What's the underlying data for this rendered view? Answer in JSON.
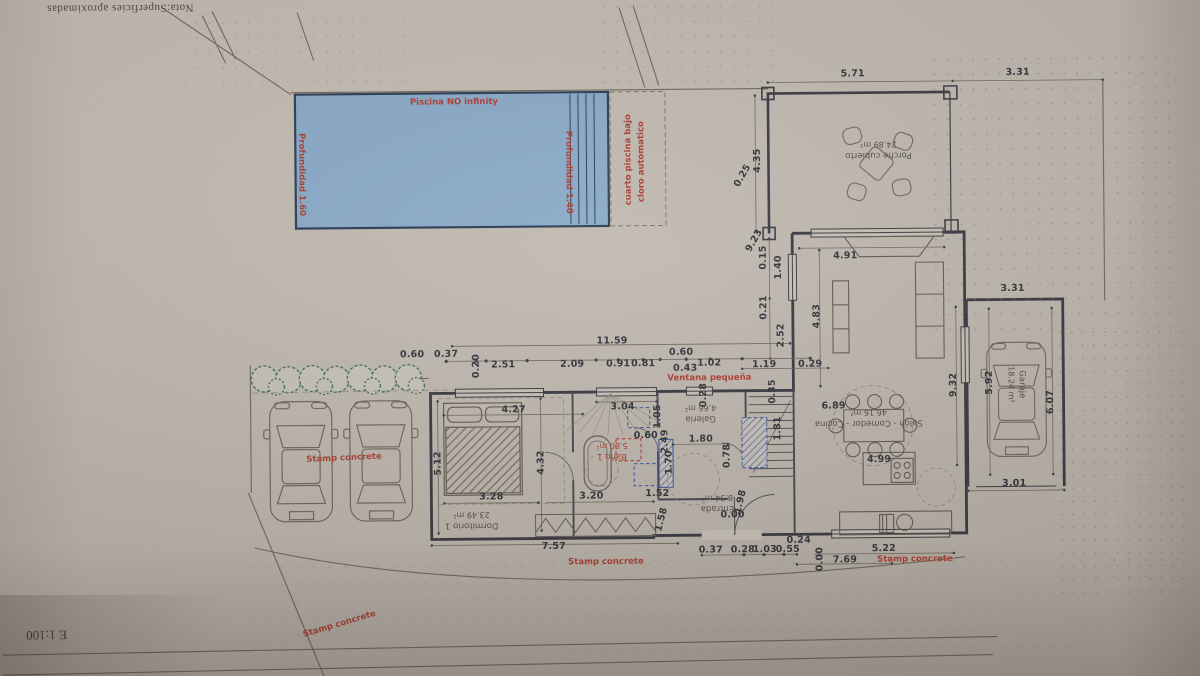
{
  "sheet": {
    "note_top": "Nota:Superficies aproximadas",
    "scale_label": "E 1:100"
  },
  "annotations": {
    "dims": [
      {
        "t": "5.71",
        "x": 855,
        "y": 76
      },
      {
        "t": "3.31",
        "x": 1020,
        "y": 76
      },
      {
        "t": "4.35",
        "x": 759,
        "y": 162,
        "r": -90
      },
      {
        "t": "0.25",
        "x": 744,
        "y": 177,
        "r": -60
      },
      {
        "t": "9.23",
        "x": 755,
        "y": 242,
        "r": -60
      },
      {
        "t": "0.15",
        "x": 764,
        "y": 259,
        "r": -90
      },
      {
        "t": "1.40",
        "x": 779,
        "y": 269,
        "r": -90
      },
      {
        "t": "0.21",
        "x": 764,
        "y": 309,
        "r": -90
      },
      {
        "t": "2.52",
        "x": 781,
        "y": 337,
        "r": -90
      },
      {
        "t": "4.83",
        "x": 817,
        "y": 318,
        "r": -90
      },
      {
        "t": "1.19",
        "x": 764,
        "y": 366
      },
      {
        "t": "0.29",
        "x": 810,
        "y": 366
      },
      {
        "t": "4.91",
        "x": 846,
        "y": 258
      },
      {
        "t": "6.89",
        "x": 833,
        "y": 408
      },
      {
        "t": "4.99",
        "x": 878,
        "y": 462
      },
      {
        "t": "9.32",
        "x": 953,
        "y": 388,
        "r": -90
      },
      {
        "t": "3.31",
        "x": 1013,
        "y": 292
      },
      {
        "t": "5.92",
        "x": 989,
        "y": 386,
        "r": -90
      },
      {
        "t": "6.07",
        "x": 1050,
        "y": 406,
        "r": -90
      },
      {
        "t": "3.01",
        "x": 1013,
        "y": 487
      },
      {
        "t": "11.59",
        "x": 612,
        "y": 341
      },
      {
        "t": "0.60",
        "x": 412,
        "y": 353
      },
      {
        "t": "0.37",
        "x": 446,
        "y": 353
      },
      {
        "t": "0.20",
        "x": 476,
        "y": 365,
        "r": -90
      },
      {
        "t": "2.51",
        "x": 503,
        "y": 364
      },
      {
        "t": "2.09",
        "x": 572,
        "y": 364
      },
      {
        "t": "0.91",
        "x": 618,
        "y": 364
      },
      {
        "t": "0.81",
        "x": 643,
        "y": 364
      },
      {
        "t": "0.60",
        "x": 681,
        "y": 353
      },
      {
        "t": "0.43",
        "x": 685,
        "y": 369
      },
      {
        "t": "1.02",
        "x": 709,
        "y": 364
      },
      {
        "t": "4.27",
        "x": 513,
        "y": 409
      },
      {
        "t": "3.04",
        "x": 622,
        "y": 407
      },
      {
        "t": "1.05",
        "x": 657,
        "y": 417,
        "r": -90
      },
      {
        "t": "2.49",
        "x": 664,
        "y": 442,
        "r": -90
      },
      {
        "t": "0.60",
        "x": 645,
        "y": 436
      },
      {
        "t": "1.70",
        "x": 668,
        "y": 463,
        "r": -90
      },
      {
        "t": "1.80",
        "x": 700,
        "y": 440
      },
      {
        "t": "0.28",
        "x": 703,
        "y": 396,
        "r": -90
      },
      {
        "t": "0.35",
        "x": 772,
        "y": 393,
        "r": -90
      },
      {
        "t": "1.81",
        "x": 777,
        "y": 430,
        "r": -90
      },
      {
        "t": "5.12",
        "x": 437,
        "y": 462,
        "r": -90
      },
      {
        "t": "4.32",
        "x": 540,
        "y": 462,
        "r": -90
      },
      {
        "t": "3.28",
        "x": 490,
        "y": 496
      },
      {
        "t": "3.20",
        "x": 590,
        "y": 496
      },
      {
        "t": "1.52",
        "x": 656,
        "y": 494
      },
      {
        "t": "1.58",
        "x": 660,
        "y": 520,
        "r": -75
      },
      {
        "t": "0.78",
        "x": 726,
        "y": 457,
        "r": -90
      },
      {
        "t": "1.98",
        "x": 739,
        "y": 503,
        "r": -75
      },
      {
        "t": "0.00",
        "x": 731,
        "y": 516
      },
      {
        "t": "7.57",
        "x": 552,
        "y": 546
      },
      {
        "t": "0.37",
        "x": 709,
        "y": 551
      },
      {
        "t": "0.28",
        "x": 741,
        "y": 551
      },
      {
        "t": "1.03",
        "x": 763,
        "y": 551
      },
      {
        "t": "0.55",
        "x": 786,
        "y": 551
      },
      {
        "t": "0.24",
        "x": 797,
        "y": 542
      },
      {
        "t": "0.00",
        "x": 818,
        "y": 561,
        "r": -90
      },
      {
        "t": "7.69",
        "x": 843,
        "y": 562
      },
      {
        "t": "5.22",
        "x": 882,
        "y": 551
      }
    ],
    "reds": [
      {
        "t": "Piscina NO infinity",
        "x": 456,
        "y": 101
      },
      {
        "t": "Profundidad 1.60",
        "x": 303,
        "y": 172,
        "r": 90
      },
      {
        "t": "Profundidad 1.40",
        "x": 570,
        "y": 172,
        "r": 90
      },
      {
        "t": "cuarto piscina bajo",
        "x": 630,
        "y": 160,
        "r": -90
      },
      {
        "t": "cloro automatico",
        "x": 643,
        "y": 162,
        "r": -90
      },
      {
        "t": "Ventana pequeña",
        "x": 709,
        "y": 379
      },
      {
        "t": "Stamp concrete",
        "x": 343,
        "y": 456,
        "r": -2
      },
      {
        "t": "Stamp concrete",
        "x": 337,
        "y": 622,
        "r": -16
      },
      {
        "t": "Stamp concrete",
        "x": 604,
        "y": 562
      },
      {
        "t": "Stamp concrete",
        "x": 913,
        "y": 562
      }
    ],
    "rooms": [
      {
        "t": "Porche cubierto",
        "t2": "24.89 m²",
        "x": 880,
        "y": 152,
        "r": 180
      },
      {
        "t": "Dormitorio 1",
        "t2": "23.49 m²",
        "x": 470,
        "y": 519,
        "r": 180
      },
      {
        "t": "Baño 1",
        "t2": "5.80 m²",
        "x": 611,
        "y": 451,
        "r": 180,
        "red": true
      },
      {
        "t": "Galería",
        "t2": "4.66 m²",
        "x": 700,
        "y": 414,
        "r": 180
      },
      {
        "t": "Entrada",
        "t2": "8.34 m²",
        "x": 716,
        "y": 504,
        "r": 180
      },
      {
        "t": "Salón - Comedor - Cocina",
        "t2": "46.16 m²",
        "x": 868,
        "y": 420,
        "r": 180
      },
      {
        "t": "Garaje",
        "t2": "18.24 m²",
        "x": 1016,
        "y": 388,
        "r": 90
      }
    ]
  }
}
